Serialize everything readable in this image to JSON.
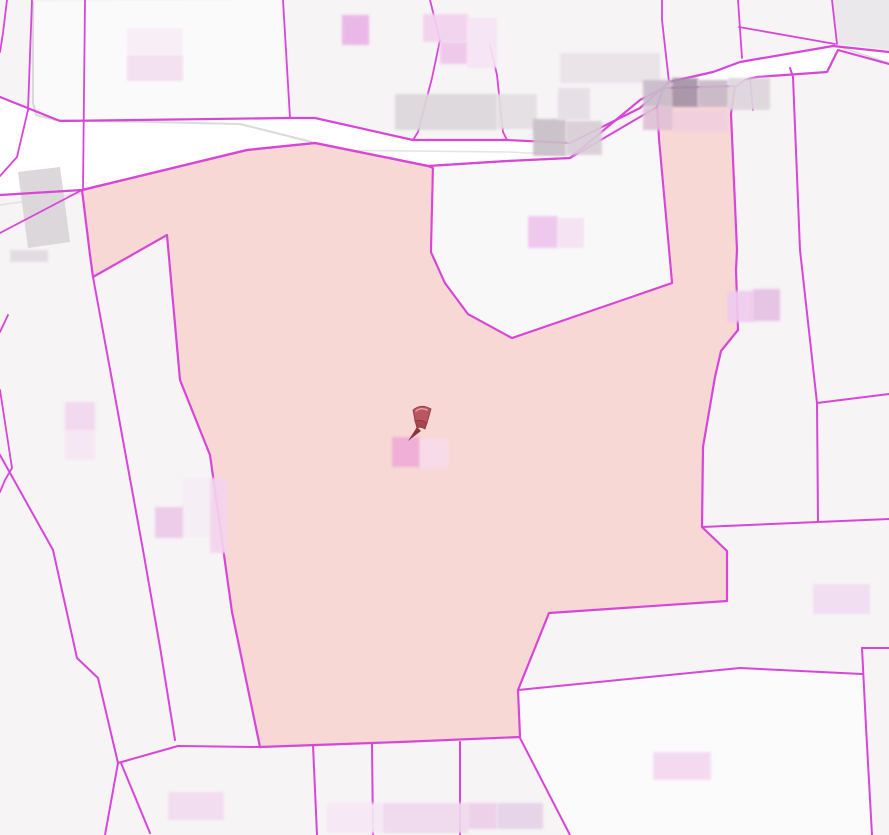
{
  "app": {
    "title": "Cadastral parcel map view"
  },
  "map": {
    "width": 889,
    "height": 835,
    "background": "#f6f4f5",
    "line_color": "#d846d8",
    "gray_line_color": "#d3cfd3",
    "road_fill": "#ffffff",
    "selected_parcel_fill": "#f7d8d5",
    "shapes": [
      {
        "name": "map-background",
        "type": "rect",
        "x": 0,
        "y": 0,
        "w2": 889,
        "h2": 835,
        "fill": "#f6f4f5"
      },
      {
        "name": "parcel-northwest",
        "type": "polygon",
        "points": "33,2 280,0 287,116 55,120 33,104",
        "fill": "#fbfafb"
      },
      {
        "name": "parcel-northeast-corner",
        "type": "polygon",
        "points": "833,0 889,0 889,50 837,44",
        "fill": "#eae8ea"
      },
      {
        "name": "parcel-bottom-large",
        "type": "polygon",
        "points": "520,738 570,835 871,835 866,727 862,674 740,668 518,690",
        "fill": "#fcfbfc"
      },
      {
        "name": "road-surface",
        "type": "polygon",
        "points": "0,97 60,121 290,118 315,118 413,140 507,140 570,143 640,108 669,82 713,72 740,62 833,46 889,52 889,64 838,50 827,72 757,77 745,80 737,86 663,88 640,100 570,158 507,161 428,166 315,143 247,150 82,190 0,195",
        "fill": "#ffffff"
      },
      {
        "name": "basemap-road-casing-1",
        "type": "polyline",
        "points": "33,2 33,103 36,115 55,120 240,124 312,142",
        "stroke": "#d3cfd3",
        "w": 2,
        "opacity": 0.8
      },
      {
        "name": "basemap-road-casing-2",
        "type": "polyline",
        "points": "0,205 140,185 240,163 312,150",
        "stroke": "#d6d2d6",
        "w": 1.5,
        "opacity": 0.6
      },
      {
        "name": "basemap-road-casing-3",
        "type": "polyline",
        "points": "315,150 507,152 570,155 620,130",
        "stroke": "#d6d2d6",
        "w": 1.5,
        "opacity": 0.6
      },
      {
        "name": "basemap-road-casing-4",
        "type": "polyline",
        "points": "840,47 889,63",
        "stroke": "#d3cfd3",
        "w": 1.5,
        "opacity": 0.8
      },
      {
        "name": "building-footprint-left",
        "type": "polygon",
        "points": "18,172 60,167 70,242 28,248",
        "fill": "#dbd7da"
      },
      {
        "name": "selected-parcel",
        "type": "polygon",
        "points": "82,190 247,150 315,143 428,166 433,168 431,252 445,283 468,314 512,338 672,283 659,140 657,106 663,88 735,86 731,114 737,250 736,270 738,330 721,351 715,377 703,447 702,527 727,551 727,601 549,613 518,690 520,737 400,742 260,747 232,612 210,455 180,380 167,235 93,277 90,255",
        "fill": "#f7d8d5",
        "stroked": true,
        "w": 2.2,
        "interactable": true
      },
      {
        "name": "parcel-notch",
        "type": "polygon",
        "points": "433,168 431,252 445,283 468,314 512,338 672,283 659,140 657,107 570,158 507,161 428,166",
        "fill": "#f9f8f9",
        "stroked": true,
        "w": 2
      },
      {
        "name": "parcel-boundary-t1",
        "type": "polyline",
        "points": "7,0 3,33 0,52",
        "w": 1.8
      },
      {
        "name": "parcel-boundary-t2",
        "type": "polyline",
        "points": "32,0 28,110 17,157 0,176",
        "w": 1.8
      },
      {
        "name": "parcel-boundary-t3",
        "type": "polyline",
        "points": "85,0 83,188",
        "w": 1.8
      },
      {
        "name": "parcel-boundary-t3b",
        "type": "polyline",
        "points": "0,233 82,190",
        "w": 1.8
      },
      {
        "name": "parcel-boundary-t4",
        "type": "polyline",
        "points": "283,0 290,118",
        "w": 1.8
      },
      {
        "name": "parcel-boundary-t5",
        "type": "polyline",
        "points": "430,0 440,40 432,78 418,132 413,140",
        "w": 1.8
      },
      {
        "name": "parcel-boundary-t6",
        "type": "polyline",
        "points": "490,45 497,75 503,132 507,140",
        "w": 1.8
      },
      {
        "name": "parcel-boundary-t7",
        "type": "polyline",
        "points": "662,0 662,20 669,82",
        "w": 1.8
      },
      {
        "name": "parcel-boundary-t8",
        "type": "polyline",
        "points": "738,0 742,58",
        "w": 1.8
      },
      {
        "name": "parcel-boundary-t9",
        "type": "polyline",
        "points": "832,0 837,44",
        "w": 1.8
      },
      {
        "name": "parcel-boundary-t10",
        "type": "polyline",
        "points": "739,27 835,44",
        "w": 1.8
      },
      {
        "name": "road-edge-north",
        "type": "polyline",
        "points": "0,97 60,121 290,118 315,118 413,140 507,140 570,143 640,108 669,82 713,72 740,62 833,46 889,52",
        "w": 2.2
      },
      {
        "name": "road-edge-south",
        "type": "polyline",
        "points": "0,195 82,190 247,150 315,143 428,166 507,161 570,158 640,100 663,88 737,86 745,80 757,77 827,72 838,50 889,64",
        "w": 2.2
      },
      {
        "name": "parcel-boundary-strip-left",
        "type": "polyline",
        "points": "0,455 53,550 77,658 98,678 118,763",
        "w": 2
      },
      {
        "name": "parcel-boundary-strip-right",
        "type": "polyline",
        "points": "93,277 112,380 143,550 160,647 175,740",
        "w": 2
      },
      {
        "name": "parcel-boundary-left-edge-1",
        "type": "polyline",
        "points": "8,315 0,332",
        "w": 1.8
      },
      {
        "name": "parcel-boundary-left-edge-2",
        "type": "polyline",
        "points": "0,390 12,468 5,480 0,492",
        "w": 1.8
      },
      {
        "name": "parcel-boundary-fork-1",
        "type": "polyline",
        "points": "118,763 105,835",
        "w": 2
      },
      {
        "name": "parcel-boundary-fork-2",
        "type": "polyline",
        "points": "121,763 150,833",
        "w": 2
      },
      {
        "name": "parcel-boundary-bottom-link",
        "type": "polyline",
        "points": "118,763 178,746 260,747",
        "w": 2
      },
      {
        "name": "parcel-boundary-b1",
        "type": "polyline",
        "points": "313,745 317,835",
        "w": 2
      },
      {
        "name": "parcel-boundary-b2",
        "type": "polyline",
        "points": "372,743 373,835",
        "w": 2
      },
      {
        "name": "parcel-boundary-b3",
        "type": "polyline",
        "points": "460,742 460,835",
        "w": 2
      },
      {
        "name": "parcel-boundary-b4",
        "type": "polyline",
        "points": "520,738 570,835",
        "w": 2
      },
      {
        "name": "parcel-boundary-r0",
        "type": "polyline",
        "points": "750,78 753,110",
        "w": 1.8
      },
      {
        "name": "parcel-boundary-r1",
        "type": "polyline",
        "points": "790,68 793,77 800,250 817,403 818,522",
        "w": 2
      },
      {
        "name": "parcel-boundary-r2",
        "type": "polyline",
        "points": "817,403 889,394",
        "w": 2
      },
      {
        "name": "parcel-boundary-r6",
        "type": "polyline",
        "points": "702,527 818,522 889,519",
        "w": 2
      },
      {
        "name": "parcel-boundary-r4",
        "type": "polyline",
        "points": "518,690 740,668 862,674",
        "w": 2
      },
      {
        "name": "parcel-boundary-r7",
        "type": "polyline",
        "points": "862,648 889,648",
        "w": 2
      },
      {
        "name": "parcel-boundary-r8",
        "type": "polyline",
        "points": "862,648 866,727 872,835",
        "w": 2
      }
    ],
    "blur_blocks": [
      {
        "name": "blurred-label-1",
        "x": 127,
        "y": 28,
        "w": 56,
        "h": 27,
        "fill": "#f8eef6"
      },
      {
        "name": "blurred-label-2",
        "x": 127,
        "y": 55,
        "w": 56,
        "h": 26,
        "fill": "#f3def0"
      },
      {
        "name": "blurred-label-3",
        "x": 342,
        "y": 15,
        "w": 27,
        "h": 30,
        "fill": "#e9b3e6"
      },
      {
        "name": "blurred-label-4",
        "x": 423,
        "y": 14,
        "w": 45,
        "h": 28,
        "fill": "#f3d2ef"
      },
      {
        "name": "blurred-label-5",
        "x": 440,
        "y": 42,
        "w": 28,
        "h": 22,
        "fill": "#eec6ea"
      },
      {
        "name": "blurred-label-6",
        "x": 467,
        "y": 18,
        "w": 30,
        "h": 50,
        "fill": "#f6e4f4"
      },
      {
        "name": "blurred-label-7",
        "x": 395,
        "y": 94,
        "w": 102,
        "h": 36,
        "fill": "#dcd7da"
      },
      {
        "name": "blurred-label-8",
        "x": 497,
        "y": 94,
        "w": 40,
        "h": 35,
        "fill": "#e4dfe2"
      },
      {
        "name": "blurred-label-9",
        "x": 533,
        "y": 119,
        "w": 33,
        "h": 37,
        "fill": "#c9bec7"
      },
      {
        "name": "blurred-label-10",
        "x": 566,
        "y": 121,
        "w": 36,
        "h": 34,
        "fill": "#d9cdd6"
      },
      {
        "name": "blurred-label-11",
        "x": 560,
        "y": 53,
        "w": 100,
        "h": 30,
        "fill": "#e9e3e9"
      },
      {
        "name": "blurred-label-12",
        "x": 558,
        "y": 88,
        "w": 32,
        "h": 32,
        "fill": "#e6dee5"
      },
      {
        "name": "blurred-label-13",
        "x": 643,
        "y": 80,
        "w": 29,
        "h": 27,
        "fill": "#c9bbca"
      },
      {
        "name": "blurred-label-14",
        "x": 672,
        "y": 78,
        "w": 26,
        "h": 29,
        "fill": "#a492a7"
      },
      {
        "name": "blurred-label-15",
        "x": 698,
        "y": 80,
        "w": 30,
        "h": 27,
        "fill": "#c8b9c8"
      },
      {
        "name": "blurred-label-16",
        "x": 728,
        "y": 78,
        "w": 42,
        "h": 32,
        "fill": "#ddd5dc"
      },
      {
        "name": "blurred-label-17",
        "x": 643,
        "y": 107,
        "w": 30,
        "h": 23,
        "fill": "#dfc0d5"
      },
      {
        "name": "blurred-label-18",
        "x": 673,
        "y": 110,
        "w": 55,
        "h": 22,
        "fill": "#f2cfdd"
      },
      {
        "name": "blurred-label-19",
        "x": 528,
        "y": 216,
        "w": 30,
        "h": 32,
        "fill": "#eec6ec"
      },
      {
        "name": "blurred-label-20",
        "x": 558,
        "y": 218,
        "w": 26,
        "h": 30,
        "fill": "#f5e1f3"
      },
      {
        "name": "blurred-label-21",
        "x": 10,
        "y": 250,
        "w": 38,
        "h": 12,
        "fill": "#e2dce2"
      },
      {
        "name": "blurred-label-22",
        "x": 65,
        "y": 402,
        "w": 30,
        "h": 30,
        "fill": "#f2d7ef"
      },
      {
        "name": "blurred-label-23",
        "x": 65,
        "y": 430,
        "w": 30,
        "h": 30,
        "fill": "#f7e6f4"
      },
      {
        "name": "blurred-label-24",
        "x": 182,
        "y": 478,
        "w": 28,
        "h": 59,
        "fill": "#f6eef5"
      },
      {
        "name": "blurred-label-25",
        "x": 155,
        "y": 507,
        "w": 28,
        "h": 31,
        "fill": "#ecc9e9"
      },
      {
        "name": "blurred-label-26",
        "x": 210,
        "y": 478,
        "w": 17,
        "h": 75,
        "fill": "#f3d4ee"
      },
      {
        "name": "blurred-label-27",
        "x": 392,
        "y": 437,
        "w": 28,
        "h": 30,
        "fill": "#efacd8"
      },
      {
        "name": "blurred-label-28",
        "x": 420,
        "y": 439,
        "w": 28,
        "h": 29,
        "fill": "#f8dcea"
      },
      {
        "name": "blurred-label-29",
        "x": 727,
        "y": 291,
        "w": 27,
        "h": 31,
        "fill": "#f0cbee"
      },
      {
        "name": "blurred-label-30",
        "x": 753,
        "y": 289,
        "w": 27,
        "h": 32,
        "fill": "#e5c0e3"
      },
      {
        "name": "blurred-label-31",
        "x": 813,
        "y": 584,
        "w": 57,
        "h": 30,
        "fill": "#f2ddf1"
      },
      {
        "name": "blurred-label-32",
        "x": 653,
        "y": 752,
        "w": 58,
        "h": 28,
        "fill": "#f4d8f1"
      },
      {
        "name": "blurred-label-33",
        "x": 168,
        "y": 792,
        "w": 56,
        "h": 28,
        "fill": "#f2dcf0"
      },
      {
        "name": "blurred-label-34",
        "x": 327,
        "y": 803,
        "w": 56,
        "h": 30,
        "fill": "#f7e7f5"
      },
      {
        "name": "blurred-label-35",
        "x": 383,
        "y": 803,
        "w": 85,
        "h": 30,
        "fill": "#f0d8ee"
      },
      {
        "name": "blurred-label-36",
        "x": 468,
        "y": 803,
        "w": 29,
        "h": 26,
        "fill": "#eccfe9"
      },
      {
        "name": "blurred-label-37",
        "x": 497,
        "y": 803,
        "w": 46,
        "h": 26,
        "fill": "#e6d2e8"
      }
    ],
    "pin": {
      "x": 422,
      "y": 424,
      "body_color": "#bb5560",
      "dark_color": "#8e3440",
      "mid_color": "#a8454f",
      "light_color": "#e2a7ad"
    }
  }
}
